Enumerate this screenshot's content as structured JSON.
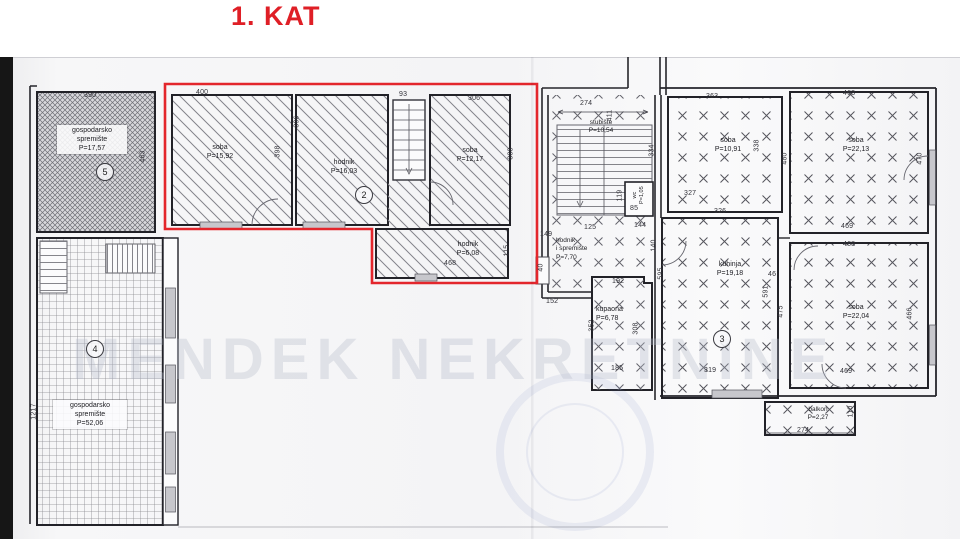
{
  "title": "1. KAT",
  "watermark": "MENDEK NEKRETNINE",
  "colors": {
    "highlight_red": "#e3262c"
  },
  "unit_numbers": {
    "u5": "5",
    "u4": "4",
    "u2": "2",
    "u3": "3"
  },
  "rooms": {
    "g5": {
      "name": "gospodarsko",
      "name2": "spremište",
      "area": "P=17,57"
    },
    "g4": {
      "name": "gospodarsko",
      "name2": "spremište",
      "area": "P=52,06"
    },
    "soba1592": {
      "name": "soba",
      "area": "P=15,92"
    },
    "hodnik1603": {
      "name": "hodnik",
      "area": "P=16,03"
    },
    "soba1217": {
      "name": "soba",
      "area": "P=12,17"
    },
    "hodnik608": {
      "name": "hodnik",
      "area": "P=6,08"
    },
    "stubiste": {
      "name": "stubište",
      "area": "P=10,54"
    },
    "hodnik770": {
      "name": "hodnik",
      "name2": "i spremište",
      "area": "P=7,70"
    },
    "wc": {
      "name": "wc",
      "area": "P=1,05"
    },
    "kupaona": {
      "name": "kupaona",
      "area": "P=6,78"
    },
    "soba1091": {
      "name": "soba",
      "area": "P=10,91"
    },
    "kuhinja": {
      "name": "kuhinja",
      "area": "P=19,18"
    },
    "soba2213": {
      "name": "soba",
      "area": "P=22,13"
    },
    "soba2204": {
      "name": "soba",
      "area": "P=22,04"
    },
    "balkon": {
      "name": "balkon",
      "area": "P=2,27"
    }
  },
  "dims": {
    "d390": "390",
    "d463a": "463",
    "d1217": "1217",
    "d400": "400",
    "d398": "398",
    "d396": "396",
    "d93": "93",
    "d306": "306",
    "d388": "388",
    "d468a": "468",
    "d115": "115",
    "d274a": "274",
    "d411": "411",
    "d334": "334",
    "d149": "149",
    "d125": "125",
    "d144": "144",
    "d140": "140",
    "d152": "152",
    "d40": "40",
    "d85": "85",
    "d119": "119",
    "d192": "192",
    "d185": "185",
    "d352": "352",
    "d308": "308",
    "d363": "363",
    "d327": "327",
    "d338": "338",
    "d480": "480",
    "d463b": "463",
    "d470": "470",
    "d469a": "469",
    "d326": "326",
    "d319": "319",
    "d595": "595",
    "d591": "591",
    "d46": "46",
    "d468b": "468",
    "d475": "475",
    "d466": "466",
    "d469b": "469",
    "d274b": "274",
    "d110": "110"
  }
}
